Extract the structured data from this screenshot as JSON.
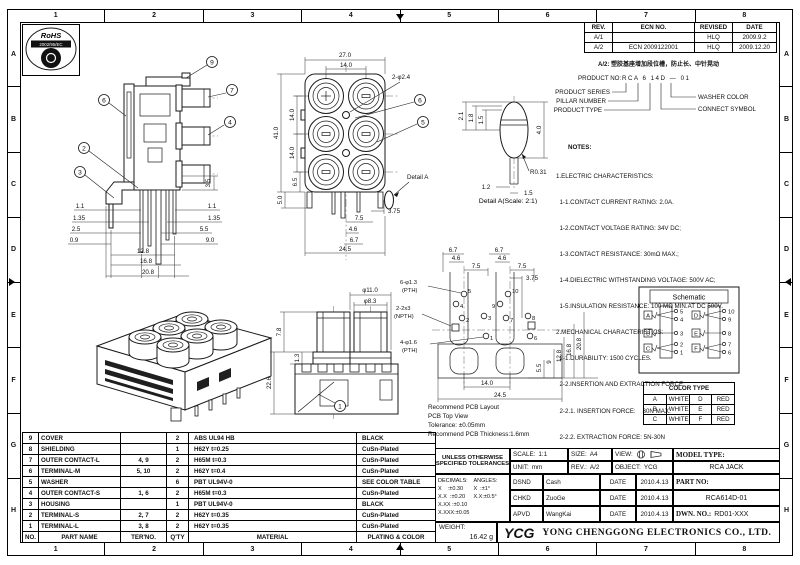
{
  "ruler": {
    "cols": [
      "1",
      "2",
      "3",
      "4",
      "5",
      "6",
      "7",
      "8"
    ],
    "rows": [
      "A",
      "B",
      "C",
      "D",
      "E",
      "F",
      "G",
      "H"
    ]
  },
  "stamp": {
    "name": "RoHS",
    "directive": "2002/95/EC"
  },
  "revisions": {
    "headers": {
      "rev": "REV.",
      "ecn": "ECN NO.",
      "revised": "REVISED",
      "date": "DATE"
    },
    "rows": [
      {
        "rev": "A/1",
        "ecn": "",
        "revised": "HLQ",
        "date": "2009.9.2"
      },
      {
        "rev": "A/2",
        "ecn": "ECN 2009122001",
        "revised": "HLQ",
        "date": "2009.12.20"
      }
    ],
    "note": "A/2: 塑胶基座增加段位槽，防止长、中针晃动"
  },
  "product_code": {
    "label": "PRODUCT NO:",
    "value": "RCA 6 14D — 01",
    "series": "PRODUCT SERIES",
    "pillar": "PILLAR NUMBER",
    "type": "PRODUCT TYPE",
    "washer": "WASHER COLOR",
    "connect": "CONNECT SYMBOL"
  },
  "notes": {
    "title": "NOTES:",
    "lines": [
      "1.ELECTRIC CHARACTERISTICS:",
      "  1-1.CONTACT CURRENT RATING: 2.0A.",
      "  1-2.CONTACT VOLTAGE RATING: 34V DC;",
      "  1-3.CONTACT RESISTANCE: 30mΩ MAX.;",
      "  1-4.DIELECTRIC WITHSTANDING VOLTAGE: 500V AC;",
      "  1-5.INSULATION RESISTANCE: 100 MΩ MIN.AT DC 500V.",
      "2.MECHANICAL CHARACTERISTICS:",
      "  2-1.DURABILITY: 1500 CYCLES.",
      "  2-2.INSERTION AND EXTRACTION FORCE:",
      "  2-2.1. INSERTION FORCE:    30N MAX.",
      "  2-2.2. EXTRACTION FORCE: 5N-30N",
      "3.ENVIRENMENT CHARACTERISTICS:",
      "  3-1.OPERATING TEMPERATURE.-25℃~+85℃",
      "  3-2.HUMIDTY: 45-85% RH."
    ]
  },
  "views": {
    "side": {
      "callouts": {
        "c9": "9",
        "c7": "7",
        "c4": "4",
        "c6": "6",
        "c2": "2",
        "c3": "3"
      },
      "dims": {
        "d35": "3.5",
        "l1": "1.1",
        "l2": "1.35",
        "l3": "2.5",
        "l4": "0.9",
        "r1": "1.1",
        "r2": "1.35",
        "r3": "5.5",
        "r4": "9.0",
        "b1": "12.8",
        "b2": "16.8",
        "b3": "20.8"
      }
    },
    "front": {
      "callouts": {
        "c6": "6",
        "c5": "5"
      },
      "detail_label": "Detail A",
      "dims": {
        "w": "27.0",
        "iw": "14.0",
        "holes": "2-φ2.4",
        "h": "41.0",
        "p1": "14.0",
        "p2": "14.0",
        "p3": "6.5",
        "p4": "5.0",
        "b1": "3.75",
        "b2": "7.5",
        "b3": "4.6",
        "b4": "6.7",
        "bw": "24.5"
      }
    },
    "detail": {
      "caption": "Detail A(Scale: 2:1)",
      "dims": {
        "d1": "2.1",
        "d2": "1.8",
        "d3": "1.5",
        "d4": "4.0",
        "r": "R0.31",
        "b1": "1.2",
        "b2": "1.5"
      }
    },
    "top": {
      "callout": "1",
      "dims": {
        "d1": "φ11.0",
        "d2": "φ8.3",
        "d3": "7.8",
        "d4": "1.3",
        "d5": "22.6"
      }
    }
  },
  "pcb": {
    "labels": {
      "pth6": "6-φ1.3",
      "pth6u": "(PTH)",
      "npth": "2-2x3",
      "npthu": "(NPTH)",
      "pth4": "4-φ1.6",
      "pth4u": "(PTH)"
    },
    "pins": {
      "p1": "1",
      "p2": "2",
      "p3": "3",
      "p4": "4",
      "p5": "5",
      "p6": "6",
      "p7": "7",
      "p8": "8",
      "p9": "9",
      "p10": "10"
    },
    "dims": {
      "tl1": "6.7",
      "tl2": "4.6",
      "tl3": "7.5",
      "tr1": "6.7",
      "tr2": "4.6",
      "tr3": "7.5",
      "t375": "3.75",
      "r1": "5.5",
      "r2": "9",
      "r3": "12.8",
      "r4": "16.8",
      "r5": "20.8",
      "b1": "14.0",
      "b2": "24.5"
    },
    "notes": [
      "Recommend PCB Layout",
      "PCB Top View",
      "Tolerance: ±0.05mm",
      "Recommend PCB Thickness:1.6mm"
    ]
  },
  "schematic": {
    "title": "Schematic",
    "left": [
      {
        "g": "A",
        "pins": [
          "5",
          "4"
        ]
      },
      {
        "g": "B",
        "pins": [
          "3"
        ]
      },
      {
        "g": "C",
        "pins": [
          "2",
          "1"
        ]
      }
    ],
    "right": [
      {
        "g": "D",
        "pins": [
          "10",
          "9"
        ]
      },
      {
        "g": "E",
        "pins": [
          "8"
        ]
      },
      {
        "g": "F",
        "pins": [
          "7",
          "6"
        ]
      }
    ]
  },
  "color_table": {
    "title": "COLOR TYPE",
    "rows": [
      [
        "A",
        "WHITE",
        "D",
        "RED"
      ],
      [
        "B",
        "WHITE",
        "E",
        "RED"
      ],
      [
        "C",
        "WHITE",
        "F",
        "RED"
      ]
    ]
  },
  "parts_table": {
    "headers": [
      "NO.",
      "PART NAME",
      "TER'NO.",
      "Q'TY",
      "MATERIAL",
      "PLATING & COLOR"
    ],
    "rows": [
      [
        "9",
        "COVER",
        "",
        "2",
        "ABS UL94 HB",
        "BLACK"
      ],
      [
        "8",
        "SHIELDING",
        "",
        "1",
        "H62Y t=0.25",
        "CuSn-Plated"
      ],
      [
        "7",
        "OUTER CONTACT-L",
        "4, 9",
        "2",
        "H65M t=0.3",
        "CuSn-Plated"
      ],
      [
        "6",
        "TERMINAL-M",
        "5, 10",
        "2",
        "H62Y t=0.4",
        "CuSn-Plated"
      ],
      [
        "5",
        "WASHER",
        "",
        "6",
        "PBT UL94V-0",
        "SEE COLOR TABLE"
      ],
      [
        "4",
        "OUTER CONTACT-S",
        "1, 6",
        "2",
        "H65M t=0.3",
        "CuSn-Plated"
      ],
      [
        "3",
        "HOUSING",
        "",
        "1",
        "PBT UL94V-0",
        "BLACK"
      ],
      [
        "2",
        "TERMINAL-S",
        "2, 7",
        "2",
        "H62Y t=0.35",
        "CuSn-Plated"
      ],
      [
        "1",
        "TERMINAL-L",
        "3, 8",
        "2",
        "H62Y t=0.35",
        "CuSn-Plated"
      ]
    ]
  },
  "title_block": {
    "tolerance_note": "UNLESS OTHERWISE\nSPECIFIED TOLERANCES",
    "decimals": "DECIMALS:\nX    :±0.30\nX.X  :±0.20\nX.XX :±0.10\nX.XXX:±0.05",
    "angles": "ANGLES:\nX  :±1°\nX.X:±0.5°",
    "scale_label": "SCALE:",
    "scale": "1:1",
    "size_label": "SIZE:",
    "size": "A4",
    "view_label": "VIEW:",
    "unit_label": "UNIT:",
    "unit": "mm",
    "rev_label": "REV.:",
    "rev": "A/2",
    "object_label": "OBJECT:",
    "object": "YCG",
    "model_label": "MODEL TYPE:",
    "model": "RCA JACK",
    "part_label": "PART NO:",
    "part": "RCA614D-01",
    "dwn_label": "DWN. NO.:",
    "dwn": "RD01-XXX",
    "sign_rows": [
      {
        "role": "DSND",
        "name": "Cash",
        "date_label": "DATE",
        "date": "2010.4.13"
      },
      {
        "role": "CHKD",
        "name": "ZuoGe",
        "date_label": "DATE",
        "date": "2010.4.13"
      },
      {
        "role": "APVD",
        "name": "WangKai",
        "date_label": "DATE",
        "date": "2010.4.13"
      }
    ],
    "weight_label": "WEIGHT:",
    "weight": "16.42 g",
    "logo": "YCG",
    "company": "YONG CHENGGONG ELECTRONICS CO., LTD."
  }
}
